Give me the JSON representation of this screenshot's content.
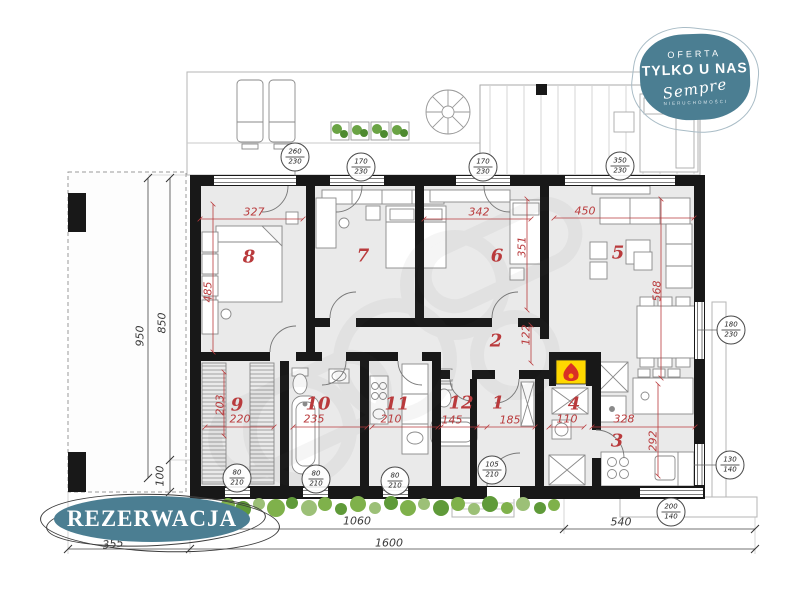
{
  "colors": {
    "accent_teal": "#4b7e92",
    "dim_red": "#b93a3c",
    "wall_black": "#181818",
    "floor_gray": "#eaeaea",
    "fireplace_yellow": "#ffd800",
    "hedge_green": "#6fa544"
  },
  "overlays": {
    "offer_badge": {
      "line1": "OFERTA",
      "line2": "TYLKO U NAS",
      "brand": "Sempre",
      "brand_sub": "NIERUCHOMOŚCI"
    },
    "reservation_badge": {
      "label": "REZERWACJA"
    }
  },
  "plan": {
    "rooms": [
      {
        "id": "r1",
        "number": "1"
      },
      {
        "id": "r2",
        "number": "2"
      },
      {
        "id": "r3",
        "number": "3"
      },
      {
        "id": "r4",
        "number": "4"
      },
      {
        "id": "r5",
        "number": "5"
      },
      {
        "id": "r6",
        "number": "6"
      },
      {
        "id": "r7",
        "number": "7"
      },
      {
        "id": "r8",
        "number": "8"
      },
      {
        "id": "r9",
        "number": "9"
      },
      {
        "id": "r10",
        "number": "10"
      },
      {
        "id": "r11",
        "number": "11"
      },
      {
        "id": "r12",
        "number": "12"
      }
    ],
    "room_dimensions": [
      {
        "id": "d327",
        "value": "327"
      },
      {
        "id": "d485",
        "value": "485"
      },
      {
        "id": "d342",
        "value": "342"
      },
      {
        "id": "d351",
        "value": "351"
      },
      {
        "id": "d450",
        "value": "450"
      },
      {
        "id": "d568",
        "value": "568"
      },
      {
        "id": "d122",
        "value": "122"
      },
      {
        "id": "d203",
        "value": "203"
      },
      {
        "id": "d220",
        "value": "220"
      },
      {
        "id": "d235",
        "value": "235"
      },
      {
        "id": "d210",
        "value": "210"
      },
      {
        "id": "d145",
        "value": "145"
      },
      {
        "id": "d185",
        "value": "185"
      },
      {
        "id": "d110",
        "value": "110"
      },
      {
        "id": "d328",
        "value": "328"
      },
      {
        "id": "d292",
        "value": "292"
      }
    ],
    "overall_dimensions": [
      {
        "id": "b950",
        "value": "950"
      },
      {
        "id": "b850",
        "value": "850"
      },
      {
        "id": "b100",
        "value": "100"
      },
      {
        "id": "b355",
        "value": "355"
      },
      {
        "id": "b1060",
        "value": "1060"
      },
      {
        "id": "b540",
        "value": "540"
      },
      {
        "id": "b1600",
        "value": "1600"
      }
    ],
    "openings": [
      {
        "id": "o1",
        "width": "260",
        "height": "230"
      },
      {
        "id": "o2",
        "width": "170",
        "height": "230"
      },
      {
        "id": "o3",
        "width": "170",
        "height": "230"
      },
      {
        "id": "o4",
        "width": "350",
        "height": "230"
      },
      {
        "id": "o5",
        "width": "180",
        "height": "230"
      },
      {
        "id": "o6",
        "width": "80",
        "height": "210"
      },
      {
        "id": "o7",
        "width": "80",
        "height": "210"
      },
      {
        "id": "o8",
        "width": "80",
        "height": "210"
      },
      {
        "id": "o9",
        "width": "105",
        "height": "210"
      },
      {
        "id": "o10",
        "width": "130",
        "height": "140"
      },
      {
        "id": "o11",
        "width": "200",
        "height": "140"
      }
    ]
  }
}
